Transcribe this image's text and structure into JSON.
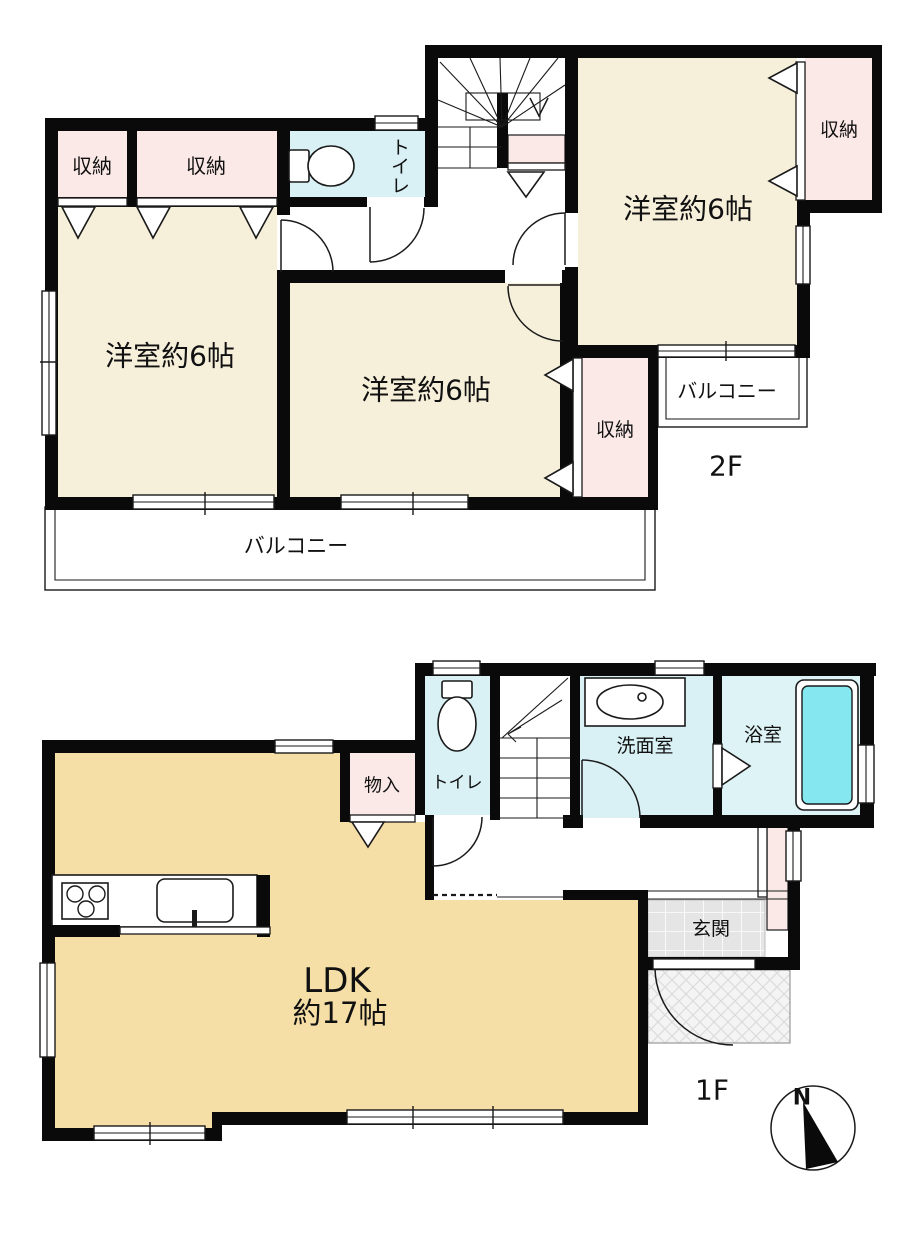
{
  "document": {
    "type": "floor-plan",
    "title": "2-story house floor plan"
  },
  "floor2": {
    "label": "2F",
    "bedroom_left": "洋室約6帖",
    "bedroom_middle": "洋室約6帖",
    "bedroom_right": "洋室約6帖",
    "closet_small_left": "収納",
    "closet_wide_left": "収納",
    "closet_right": "収納",
    "closet_middle": "収納",
    "toilet": "トイレ",
    "balcony_south": "バルコニー",
    "balcony_east": "バルコニー"
  },
  "floor1": {
    "label": "1F",
    "ldk_name": "LDK",
    "ldk_size": "約17帖",
    "storage": "物入",
    "toilet": "トイレ",
    "washroom": "洗面室",
    "bathroom": "浴室",
    "entrance": "玄関"
  },
  "compass": {
    "north_label": "N"
  },
  "colors": {
    "wall": "#0a0a0a",
    "bedroom_cream": "#f6efda",
    "ldk_tan": "#f5dfa7",
    "closet_pink": "#fbe9e7",
    "water_blue": "#d9f1f5",
    "bath_blue": "#def3f6",
    "bathtub_cyan": "#85e7ef",
    "entrance_tile_gray": "#e5e5e5"
  }
}
